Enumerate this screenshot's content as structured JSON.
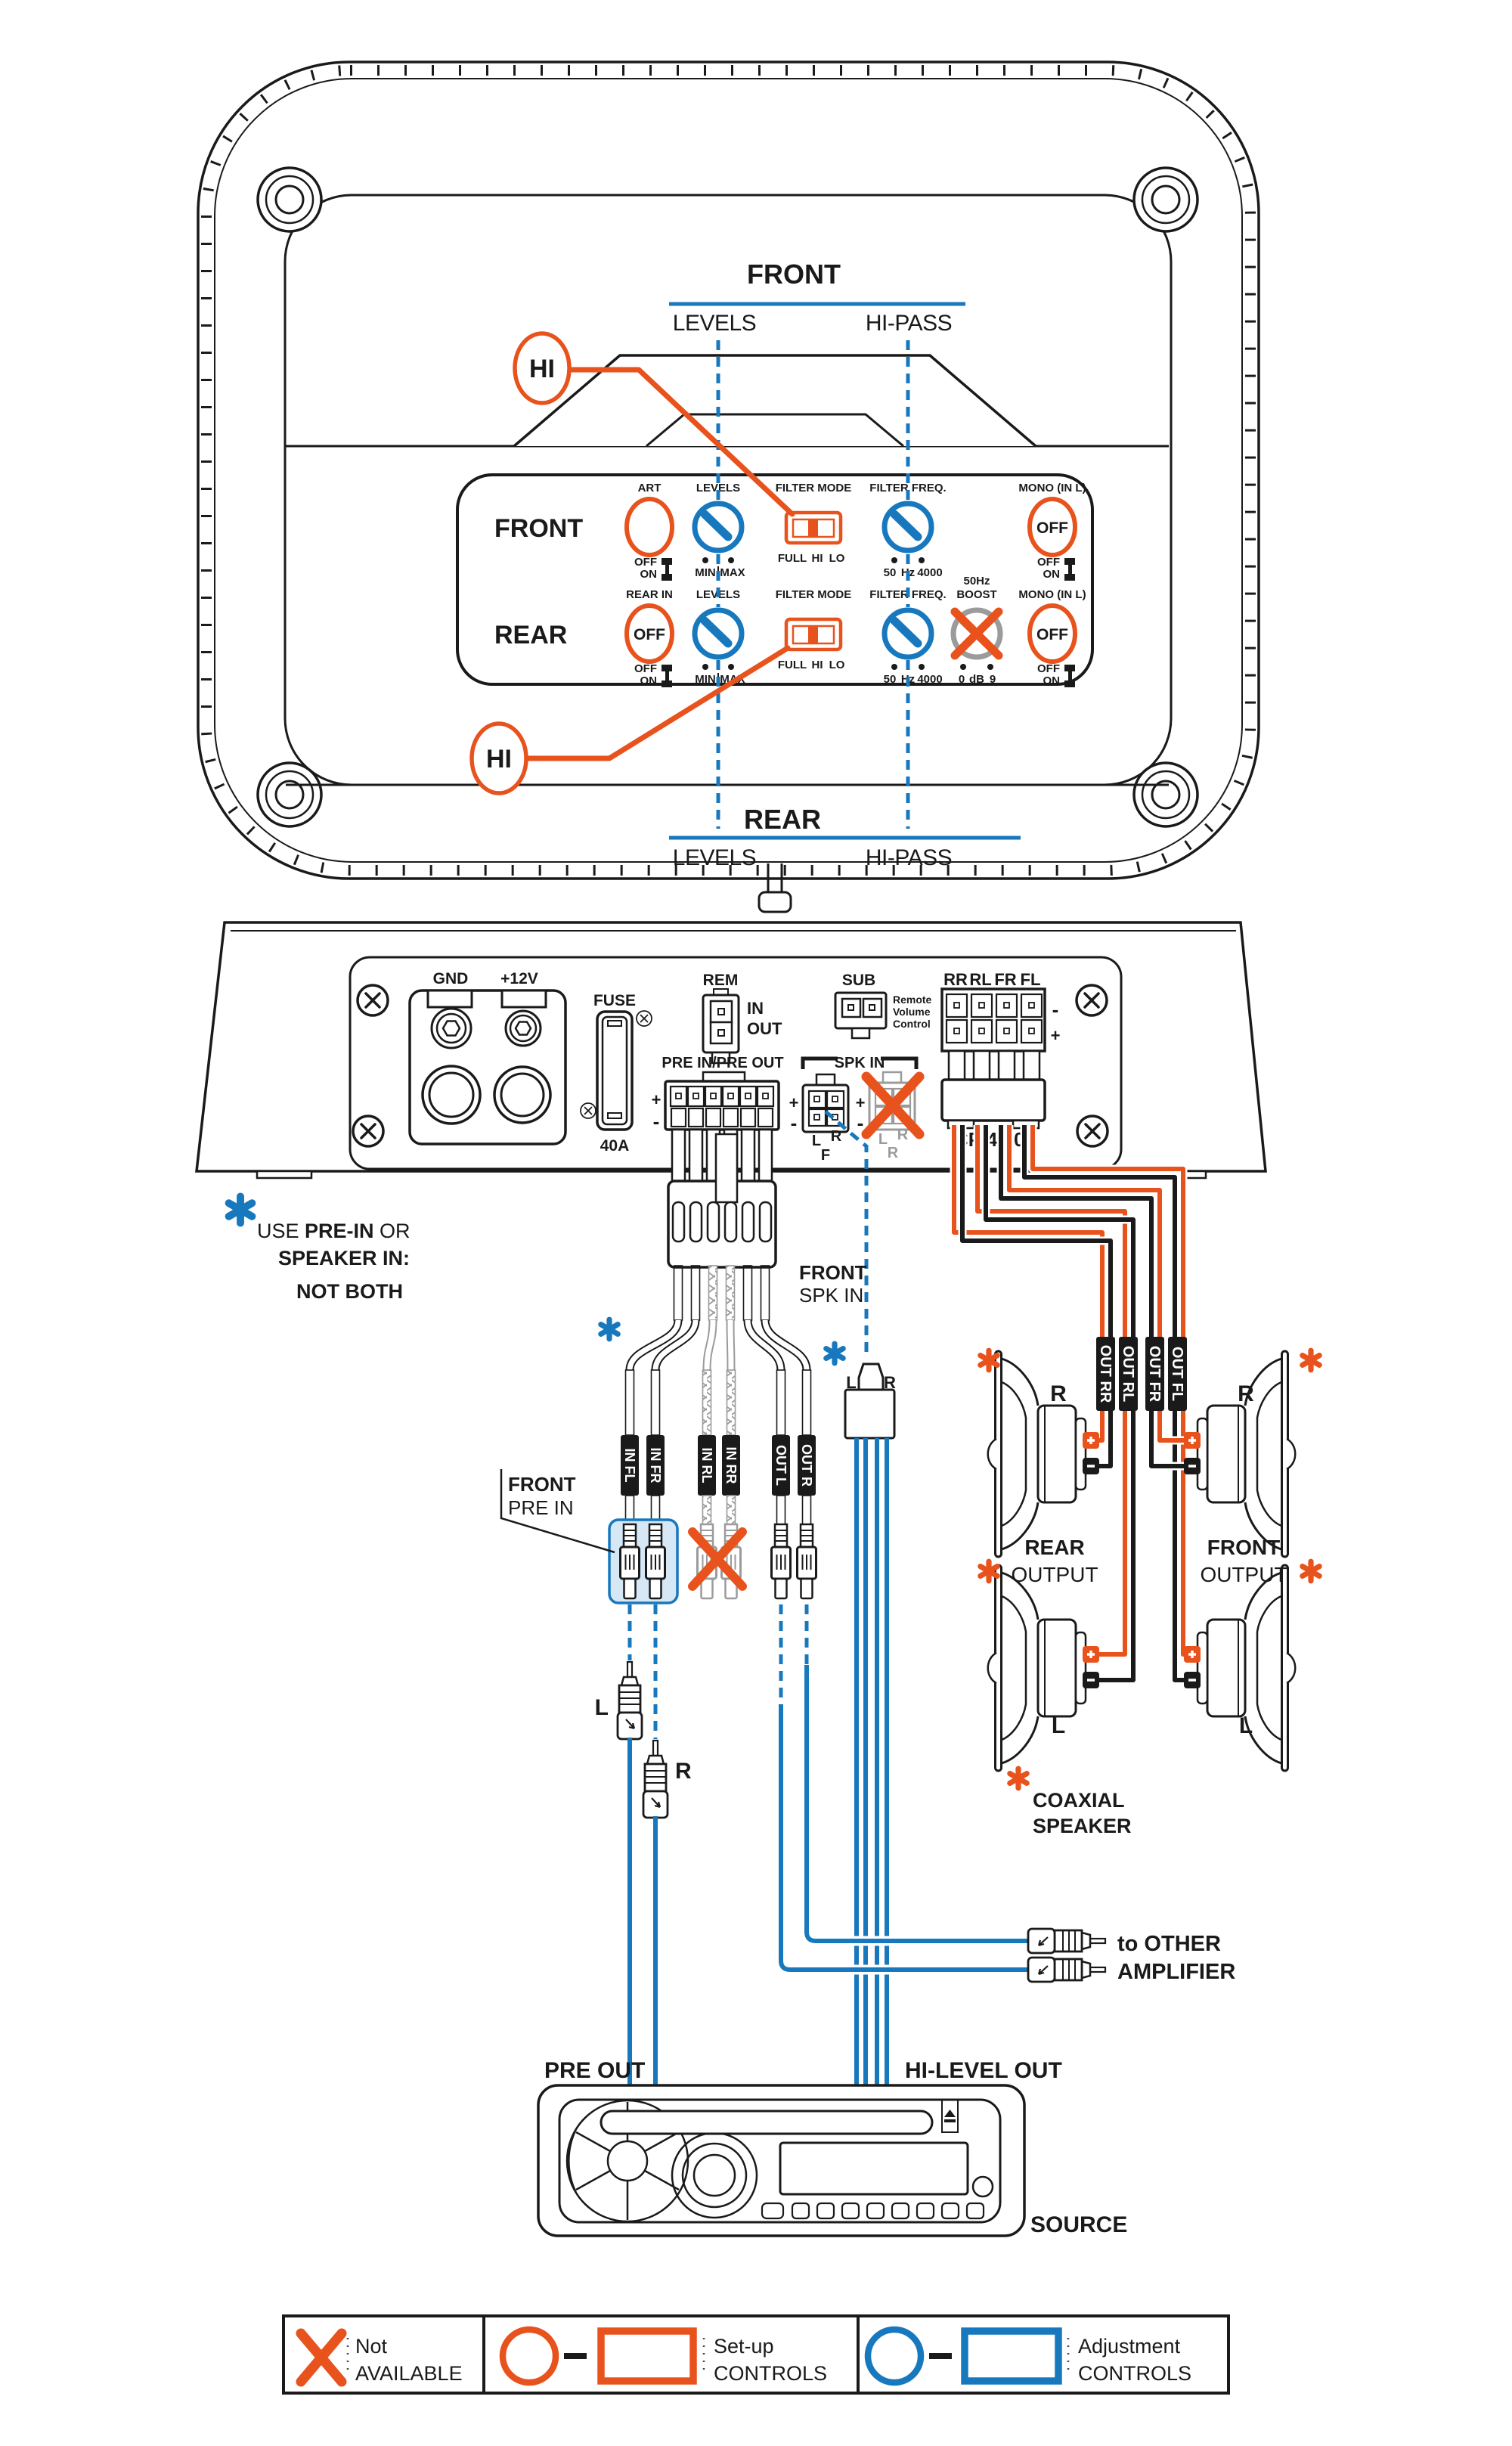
{
  "colors": {
    "orange": "#E8521D",
    "blue": "#1878BE",
    "gray": "#9B9B9B",
    "ink": "#1A1A1A",
    "highlight_fill": "#D6E7F5"
  },
  "icons": {
    "asterisk_blue": "note-asterisk",
    "asterisk_orange": "coaxial-asterisk",
    "screw": "screw-head",
    "eject": "eject-symbol",
    "not_available": "orange-x"
  },
  "hi_callout": {
    "top": "HI",
    "bottom": "HI"
  },
  "front_header": {
    "title": "FRONT",
    "levels": "LEVELS",
    "hipass": "HI-PASS"
  },
  "rear_header": {
    "title": "REAR",
    "levels": "LEVELS",
    "hipass": "HI-PASS"
  },
  "panel": {
    "front_label": "FRONT",
    "rear_label": "REAR",
    "art": {
      "header": "ART",
      "off": "OFF",
      "on": "ON"
    },
    "levels_front": {
      "header": "LEVELS",
      "min": "MIN",
      "max": "MAX"
    },
    "mode_front": {
      "header": "FILTER MODE",
      "full": "FULL",
      "hi": "HI",
      "lo": "LO"
    },
    "freq_front": {
      "header": "FILTER FREQ.",
      "lo": "50",
      "unit": "Hz",
      "hi": "4000"
    },
    "mono_front": {
      "header": "MONO (IN L)",
      "value": "OFF",
      "off": "OFF",
      "on": "ON"
    },
    "rear_in": {
      "header": "REAR IN",
      "value": "OFF",
      "off": "OFF",
      "on": "ON"
    },
    "levels_rear": {
      "header": "LEVELS",
      "min": "MIN",
      "max": "MAX"
    },
    "mode_rear": {
      "header": "FILTER MODE",
      "full": "FULL",
      "hi": "HI",
      "lo": "LO"
    },
    "freq_rear": {
      "header": "FILTER FREQ.",
      "lo": "50",
      "unit": "Hz",
      "hi": "4000"
    },
    "boost": {
      "header_line1": "50Hz",
      "header_line2": "BOOST",
      "lo": "0",
      "unit": "dB",
      "hi": "9"
    },
    "mono_rear": {
      "header": "MONO (IN L)",
      "value": "OFF",
      "off": "OFF",
      "on": "ON"
    }
  },
  "rear_panel": {
    "gnd": "GND",
    "power": "+12V",
    "fuse": "FUSE",
    "fuse_rating": "40A",
    "rem": "REM",
    "rem_in": "IN",
    "rem_out": "OUT",
    "sub": "SUB",
    "sub_note_1": "Remote",
    "sub_note_2": "Volume",
    "sub_note_3": "Control",
    "pre": "PRE IN/PRE OUT",
    "spk_in": "SPK IN",
    "minus": "-",
    "plus": "+",
    "ch_rr": "RR",
    "ch_rl": "RL",
    "ch_fr": "FR",
    "ch_fl": "FL",
    "model": "CP 4.300",
    "front_l": "L",
    "front_r": "R",
    "front_f": "F",
    "rear_l": "L",
    "rear_r": "R",
    "rear_r2": "R"
  },
  "note": {
    "line1_a": "USE ",
    "line1_b": "PRE-IN",
    "line1_c": " OR",
    "line2": "SPEAKER IN:",
    "line3": "NOT BOTH"
  },
  "cables": {
    "tag_in_fl": "IN FL",
    "tag_in_fr": "IN FR",
    "tag_in_rl": "IN RL",
    "tag_in_rr": "IN RR",
    "tag_out_l": "OUT L",
    "tag_out_r": "OUT R",
    "front_pre_1": "FRONT",
    "front_pre_2": "PRE IN",
    "front_spk_1": "FRONT",
    "front_spk_2": "SPK IN",
    "plug_l": "L",
    "plug_r": "R",
    "rca_l": "L",
    "rca_r": "R",
    "tag_out_rr": "OUT RR",
    "tag_out_rl": "OUT RL",
    "tag_out_fr": "OUT FR",
    "tag_out_fl": "OUT FL"
  },
  "speakers": {
    "rear_1": "REAR",
    "rear_2": "OUTPUT",
    "front_1": "FRONT",
    "front_2": "OUTPUT",
    "right": "R",
    "left": "L",
    "coax_1": "COAXIAL",
    "coax_2": "SPEAKER"
  },
  "source": {
    "pre_out": "PRE OUT",
    "hi_level_out": "HI-LEVEL OUT",
    "label": "SOURCE",
    "other_amp_1": "to OTHER",
    "other_amp_2": "AMPLIFIER"
  },
  "legend": {
    "na_1": "Not",
    "na_2": "AVAILABLE",
    "setup_1": "Set-up",
    "setup_2": "CONTROLS",
    "adj_1": "Adjustment",
    "adj_2": "CONTROLS"
  }
}
